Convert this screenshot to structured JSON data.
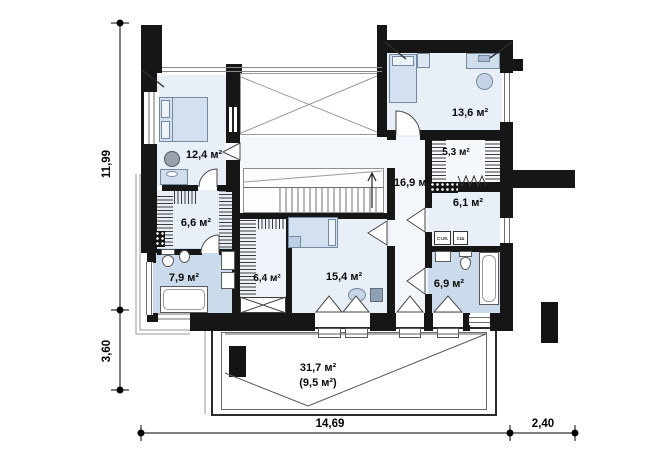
{
  "plan": {
    "rooms": {
      "bedroom_left": {
        "area": "12,4 м²"
      },
      "bedroom_topright": {
        "area": "13,6 м²"
      },
      "closet_topright": {
        "area": "5,3 м²"
      },
      "hall": {
        "area": "16,9 м²"
      },
      "laundry": {
        "area": "6,1 м²"
      },
      "closet_left": {
        "area": "6,6 м²"
      },
      "bathroom_left": {
        "area": "7,9 м²"
      },
      "wardrobe_mid": {
        "area": "6,4 м²"
      },
      "bedroom_bottom": {
        "area": "15,4 м²"
      },
      "bathroom_right": {
        "area": "6,9 м²"
      },
      "terrace": {
        "area": "31,7 м²",
        "area_secondary": "(9,5 м²)"
      }
    },
    "appliances": {
      "washer": "Ст.М.",
      "dryer": "СШ"
    },
    "dimensions": {
      "left_upper": "11,99",
      "left_lower": "3,60",
      "bottom_main": "14,69",
      "bottom_right": "2,40"
    },
    "colors": {
      "wall": "#161616",
      "room": "#e9eff7",
      "wet_room": "#ccdbeb"
    }
  }
}
